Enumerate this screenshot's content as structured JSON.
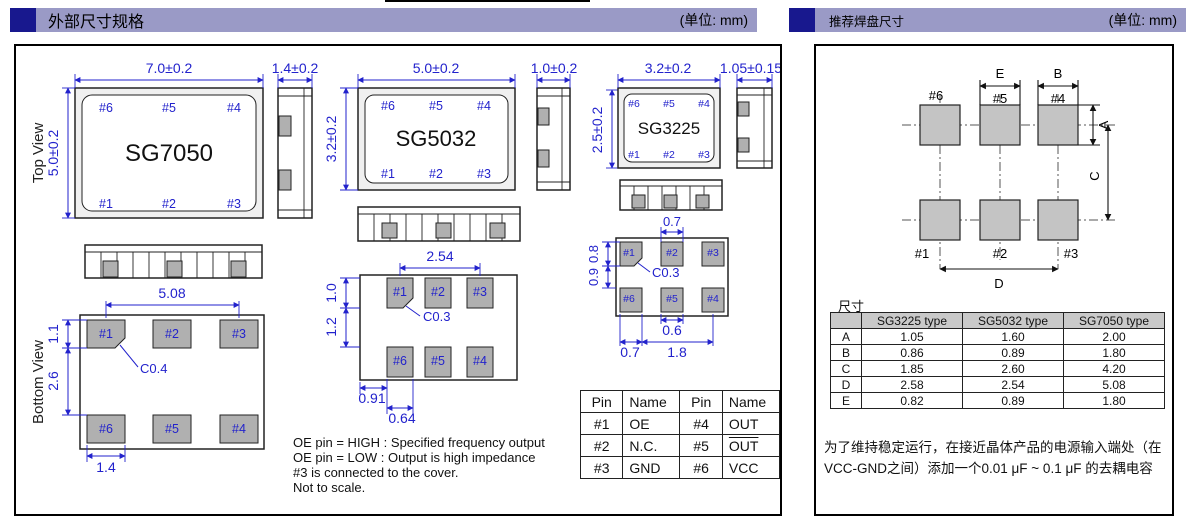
{
  "left": {
    "title": "外部尺寸规格",
    "unit": "(单位: mm)",
    "top_view": "Top View",
    "bottom_view": "Bottom View",
    "pins": {
      "a": [
        "#6",
        "#5",
        "#4"
      ],
      "b": [
        "#1",
        "#2",
        "#3"
      ]
    },
    "sg7050": {
      "name": "SG7050",
      "w": "7.0±0.2",
      "h": "5.0±0.2",
      "t": "1.4±0.2",
      "pitch": "5.08",
      "pad_h": "1.1",
      "gap": "2.6",
      "pad_w": "1.4",
      "chamfer": "C0.4"
    },
    "sg5032": {
      "name": "SG5032",
      "w": "5.0±0.2",
      "h": "3.2±0.2",
      "t": "1.0±0.2",
      "pitch": "2.54",
      "pad_h": "1.0",
      "gap": "1.2",
      "off": "0.91",
      "pad_w": "0.64",
      "chamfer": "C0.3"
    },
    "sg3225": {
      "name": "SG3225",
      "w": "3.2±0.2",
      "h": "2.5±0.2",
      "t": "1.05±0.15",
      "top_w": "0.7",
      "pad_h": "0.8",
      "gap": "0.9",
      "mid_w": "0.6",
      "off": "0.7",
      "pitch": "1.8",
      "chamfer": "C0.3"
    },
    "pin_table": {
      "headers": [
        "Pin",
        "Name",
        "Pin",
        "Name"
      ],
      "rows": [
        [
          "#1",
          "OE",
          "#4",
          "OUT"
        ],
        [
          "#2",
          "N.C.",
          "#5",
          "OUT"
        ],
        [
          "#3",
          "GND",
          "#6",
          "VCC"
        ]
      ]
    },
    "notes": [
      "OE pin = HIGH : Specified frequency output",
      "OE pin = LOW : Output is high impedance",
      "#3 is connected to the cover.",
      "Not to scale."
    ]
  },
  "right": {
    "title": "推荐焊盘尺寸",
    "unit": "(单位: mm)",
    "pins_top": [
      "#6",
      "#5",
      "#4"
    ],
    "pins_bottom": [
      "#1",
      "#2",
      "#3"
    ],
    "dims": {
      "a": "A",
      "b": "B",
      "c": "C",
      "d": "D",
      "e": "E"
    },
    "table_title": "尺寸",
    "table": {
      "headers": [
        "",
        "SG3225 type",
        "SG5032 type",
        "SG7050 type"
      ],
      "rows": [
        [
          "A",
          "1.05",
          "1.60",
          "2.00"
        ],
        [
          "B",
          "0.86",
          "0.89",
          "1.80"
        ],
        [
          "C",
          "1.85",
          "2.60",
          "4.20"
        ],
        [
          "D",
          "2.58",
          "2.54",
          "5.08"
        ],
        [
          "E",
          "0.82",
          "0.89",
          "1.80"
        ]
      ]
    },
    "note": "为了维持稳定运行，在接近晶体产品的电源输入端处（在VCC-GND之间）添加一个0.01 μF ~ 0.1 μF 的去耦电容"
  }
}
